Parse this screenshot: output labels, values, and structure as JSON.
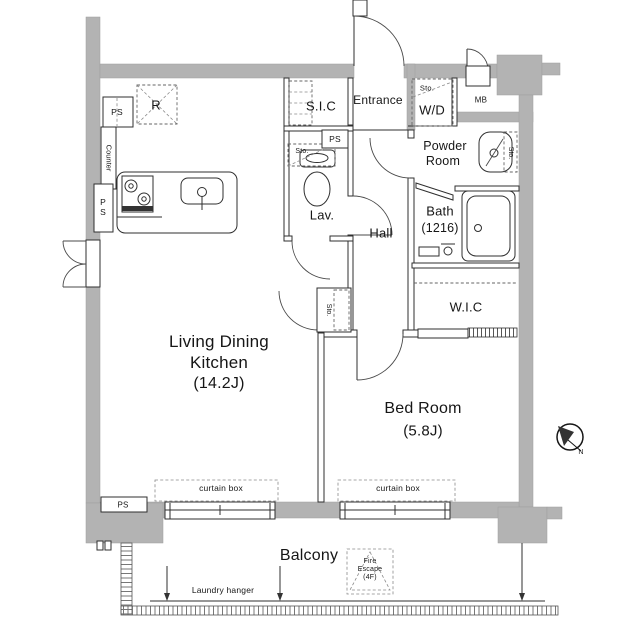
{
  "colors": {
    "wall": "#b3b3b3",
    "line": "#2f2f2f",
    "text": "#161616"
  },
  "rooms": {
    "ldk": {
      "name_line1": "Living Dining",
      "name_line2": "Kitchen",
      "size": "(14.2J)"
    },
    "bedroom": {
      "name": "Bed Room",
      "size": "(5.8J)"
    },
    "entrance": {
      "name": "Entrance"
    },
    "hall": {
      "name": "Hall"
    },
    "sic": {
      "name": "S.I.C"
    },
    "lav": {
      "name": "Lav."
    },
    "wd": {
      "name": "W/D"
    },
    "powder": {
      "name_line1": "Powder",
      "name_line2": "Room"
    },
    "bath": {
      "name": "Bath",
      "size": "(1216)"
    },
    "wic": {
      "name": "W.I.C"
    },
    "balcony": {
      "name": "Balcony"
    }
  },
  "fixtures": {
    "refrigerator": "R",
    "meter_box": "MB",
    "counter": "Counter",
    "ps_top": "PS",
    "ps_side_line1": "P",
    "ps_side_line2": "S",
    "ps_entry": "PS",
    "ps_bottom": "PS",
    "sto_lav": "Sto.",
    "sto_wd": "Sto.",
    "sto_powder": "Sto.",
    "sto_ldk": "Sto."
  },
  "annotations": {
    "curtain_box_left": "curtain box",
    "curtain_box_right": "curtain box",
    "laundry_hanger": "Laundry hanger",
    "fire_escape_line1": "Fire",
    "fire_escape_line2": "Escape",
    "fire_escape_line3": "(4F)",
    "compass_north": "N"
  }
}
